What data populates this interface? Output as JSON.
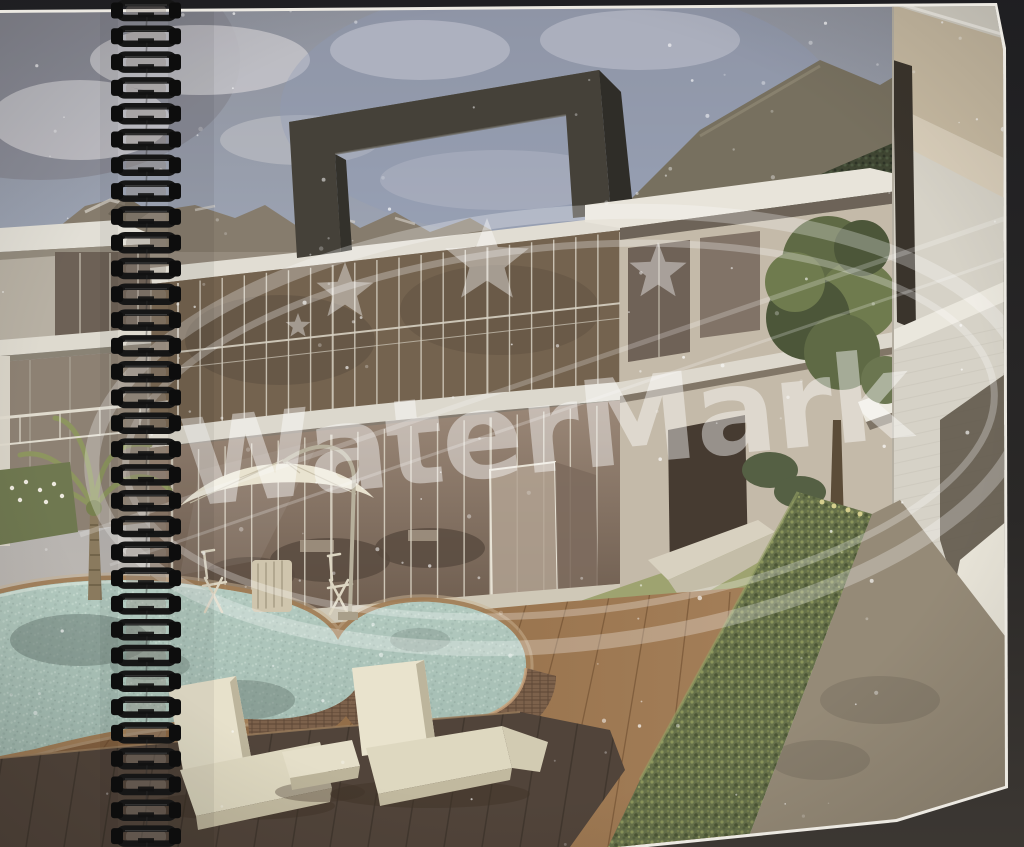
{
  "photo": {
    "subject": "spiral-bound brochure page with architectural villa rendering",
    "watermark_text": "WaterMark",
    "binding": {
      "coil_count": 33,
      "wire_color": "#161616"
    },
    "colors": {
      "backdrop": "#232226",
      "page_edge": "#ece9e2",
      "sky": "#9aa1b0",
      "frame": "#454139",
      "villa_wall": "#c4baa9",
      "pool_water": "#a9c2b8",
      "deck_wood": "#8f6a46",
      "hedge": "#68734b",
      "lawn": "#9ea370",
      "watermark": "#ffffff"
    }
  }
}
